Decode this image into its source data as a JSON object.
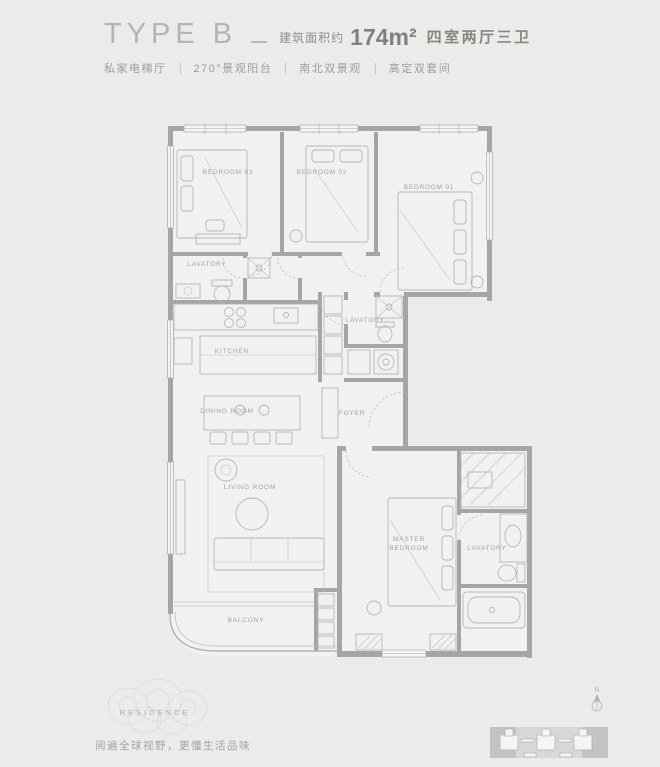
{
  "header": {
    "type_label": "TYPE B",
    "area_prefix": "建筑面积约",
    "area_value": "174m²",
    "rooms_label": "四室两厅三卫",
    "tags": [
      "私家电梯厅",
      "270°景观阳台",
      "南北双景观",
      "高定双套间"
    ]
  },
  "plan": {
    "labels": {
      "bedroom03": "BEDROOM 03",
      "bedroom02": "BEDROOM 02",
      "bedroom01": "BEDROOM 01",
      "lavatory_north": "LAVATORY",
      "kitchen": "KITCHEN",
      "lavatory_middle": "LAVATORY",
      "dining": "DINING ROOM",
      "foyer": "FOYER",
      "living": "LIVING ROOM",
      "master_line1": "MASTER",
      "master_line2": "BEDROOM",
      "lavatory_master": "LAVATORY",
      "balcony": "BALCONY"
    }
  },
  "footer": {
    "logo_text": "RESIDENCE",
    "slogan": "阅遍全球视野，更懂生活品味",
    "north_label": "N"
  },
  "colors": {
    "background": "#ecebe9",
    "wall": "#a5a5a3",
    "furniture_line": "#b6b6b4",
    "label_text": "#a2a2a0",
    "title_text": "#b2b5b2",
    "dark_text": "#83887f"
  }
}
